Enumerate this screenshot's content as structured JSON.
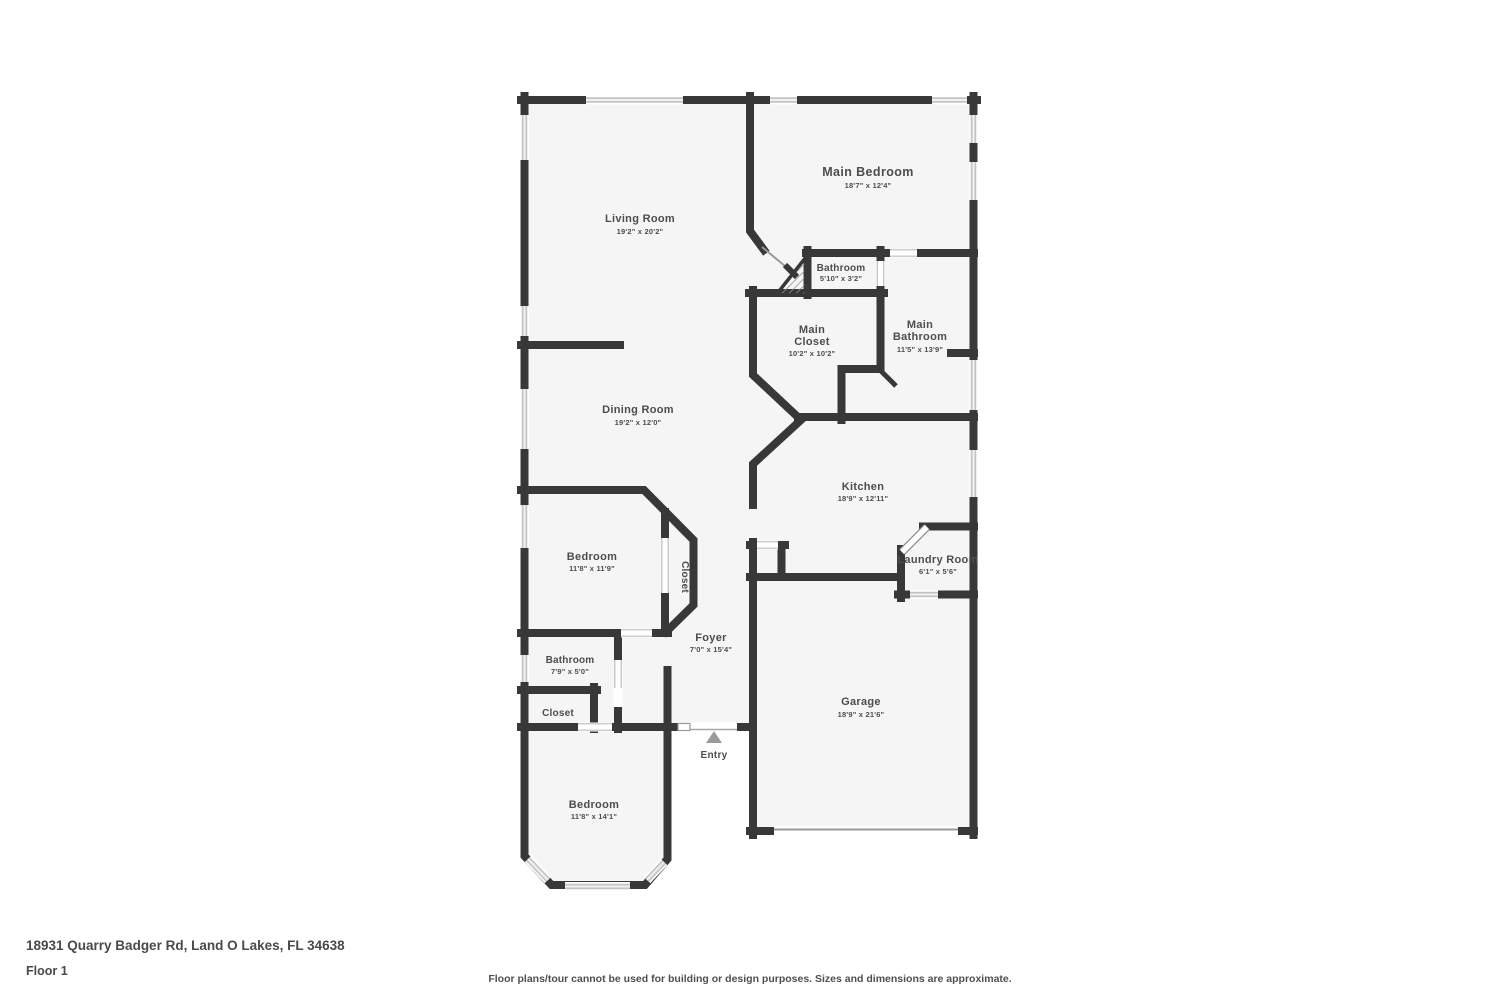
{
  "footer": {
    "address": "18931 Quarry Badger Rd, Land O Lakes, FL 34638",
    "floor_label": "Floor 1",
    "disclaimer": "Floor plans/tour cannot be used for building or design purposes. Sizes and dimensions are approximate."
  },
  "colors": {
    "wall": "#383838",
    "floor": "#f5f5f5",
    "window_frame": "#c4c4c4",
    "label_text": "#4d4d4d",
    "entry_marker": "#9a9a9a"
  },
  "floorplan": {
    "entry": {
      "label": "Entry"
    },
    "rooms": [
      {
        "id": "living-room",
        "name": "Living Room",
        "dims": "19'2\" x 20'2\""
      },
      {
        "id": "main-bedroom",
        "name": "Main Bedroom",
        "dims": "18'7\" x 12'4\""
      },
      {
        "id": "bathroom-small",
        "name": "Bathroom",
        "dims": "5'10\" x 3'2\""
      },
      {
        "id": "main-closet",
        "name1": "Main",
        "name2": "Closet",
        "dims": "10'2\" x 10'2\""
      },
      {
        "id": "main-bathroom",
        "name1": "Main",
        "name2": "Bathroom",
        "dims": "11'5\" x 13'9\""
      },
      {
        "id": "dining-room",
        "name": "Dining Room",
        "dims": "19'2\" x 12'0\""
      },
      {
        "id": "kitchen",
        "name": "Kitchen",
        "dims": "18'9\" x 12'11\""
      },
      {
        "id": "bedroom-1",
        "name": "Bedroom",
        "dims": "11'8\" x 11'9\""
      },
      {
        "id": "closet-1",
        "name": "Closet"
      },
      {
        "id": "laundry-room",
        "name": "Laundry Room",
        "dims": "6'1\" x 5'6\""
      },
      {
        "id": "foyer",
        "name": "Foyer",
        "dims": "7'0\" x 15'4\""
      },
      {
        "id": "bathroom-1",
        "name": "Bathroom",
        "dims": "7'9\" x 5'0\""
      },
      {
        "id": "closet-2",
        "name": "Closet"
      },
      {
        "id": "bedroom-2",
        "name": "Bedroom",
        "dims": "11'8\" x 14'1\""
      },
      {
        "id": "garage",
        "name": "Garage",
        "dims": "18'9\" x 21'6\""
      }
    ]
  }
}
